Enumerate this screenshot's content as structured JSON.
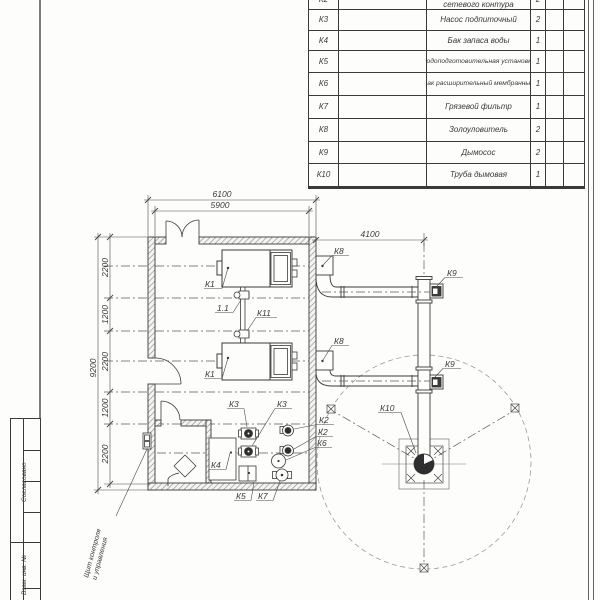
{
  "spec_table": {
    "rows": [
      {
        "pos": "К2",
        "name": "сетевого контура",
        "qty": "2"
      },
      {
        "pos": "К3",
        "name": "Насос подпиточный",
        "qty": "2"
      },
      {
        "pos": "К4",
        "name": "Бак запаса воды",
        "qty": "1"
      },
      {
        "pos": "К5",
        "name": "Водоподготовительная установка",
        "qty": "1"
      },
      {
        "pos": "К6",
        "name": "Бак расширительный мембранный",
        "qty": "1"
      },
      {
        "pos": "К7",
        "name": "Грязевой фильтр",
        "qty": "1"
      },
      {
        "pos": "К8",
        "name": "Золоуловитель",
        "qty": "2"
      },
      {
        "pos": "К9",
        "name": "Дымосос",
        "qty": "2"
      },
      {
        "pos": "К10",
        "name": "Труба дымовая",
        "qty": "1"
      }
    ]
  },
  "margin_stamp": {
    "agreed": "Согласовано",
    "inv": "Взам. инв. №"
  },
  "dimensions": {
    "overall_width": "6100",
    "inner_width": "5900",
    "flue_offset": "4100",
    "overall_height": "9200",
    "chain": [
      "2200",
      "1200",
      "2200",
      "1200",
      "2200"
    ]
  },
  "equipment_labels": {
    "k1": "К1",
    "k2": "К2",
    "k3": "К3",
    "k4": "К4",
    "k5": "К5",
    "k6": "К6",
    "k7": "К7",
    "k8": "К8",
    "k9": "К9",
    "k10": "К10",
    "k11": "К11",
    "v11": "1.1"
  },
  "annotations": {
    "panel_line1": "Щит контроля",
    "panel_line2": "и управления"
  }
}
